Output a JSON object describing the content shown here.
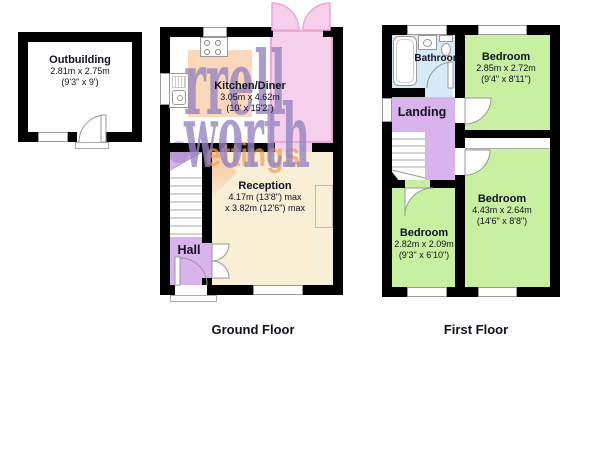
{
  "watermark": {
    "word1": "rrell",
    "word2": "worth",
    "word3": "ettings"
  },
  "outbuilding": {
    "name": "Outbuilding",
    "dims_metric": "2.81m x 2.75m",
    "dims_imperial": "(9'3\" x 9')"
  },
  "ground_floor": {
    "label": "Ground Floor",
    "kitchen_diner": {
      "name": "Kitchen/Diner",
      "dims_metric": "3.05m x 4.62m",
      "dims_imperial": "(10' x 15'2\")"
    },
    "reception": {
      "name": "Reception",
      "dims_line1": "4.17m (13'8\") max",
      "dims_line2": "x 3.82m (12'6\") max"
    },
    "hall": {
      "name": "Hall"
    }
  },
  "first_floor": {
    "label": "First Floor",
    "bathroom": {
      "name": "Bathroom"
    },
    "landing": {
      "name": "Landing"
    },
    "bedroom_front": {
      "name": "Bedroom",
      "dims_metric": "2.85m x 2.72m",
      "dims_imperial": "(9'4\" x 8'11\")"
    },
    "bedroom_rear_large": {
      "name": "Bedroom",
      "dims_metric": "4.43m x 2.64m",
      "dims_imperial": "(14'6\" x 8'8\")"
    },
    "bedroom_rear_small": {
      "name": "Bedroom",
      "dims_metric": "2.82m x 2.09m",
      "dims_imperial": "(9'3\" x 6'10\")"
    }
  },
  "colors": {
    "wall": "#000000",
    "bedroom_green": "#c8f0a0",
    "hall_purple": "#d9b4ec",
    "bathroom_blue": "#d6ebf7",
    "reception_cream": "#f9eed6",
    "conservatory_pink": "#f6cfec",
    "watermark_purple": "#9886c0",
    "watermark_orange": "#f5a05a"
  }
}
